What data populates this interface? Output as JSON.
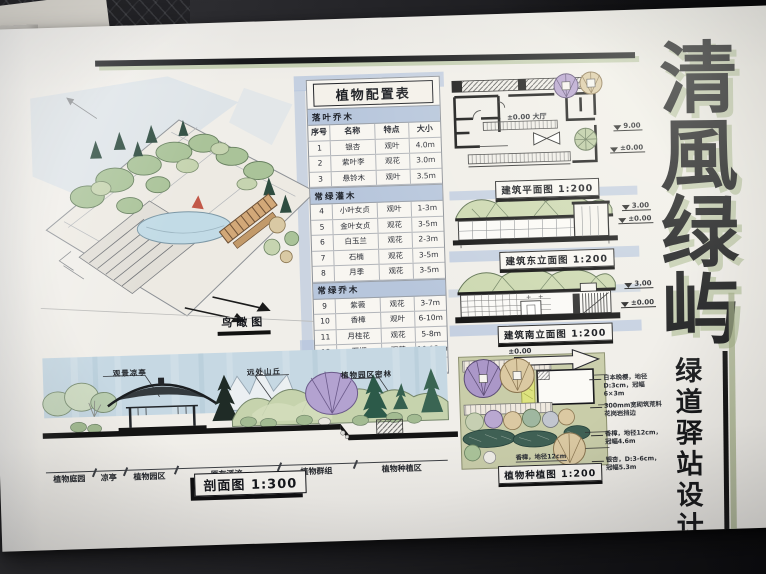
{
  "photo": {
    "paper_color": "#f0eee9",
    "desk_color": "#232327",
    "ink": "#1b1d20",
    "wash_blue": "#c6d8e3",
    "band_blue": "#b7c6dd",
    "marker_green": "#b9c7a2"
  },
  "title": {
    "main": "清風绿屿",
    "main_chars": [
      "清",
      "風",
      "绿",
      "屿"
    ],
    "sub": "绿道驿站设计",
    "sub_chars": [
      "绿",
      "道",
      "驿",
      "站",
      "设",
      "计"
    ]
  },
  "plant_table": {
    "title": "植物配置表",
    "columns": [
      "序号",
      "名称",
      "特点",
      "大小"
    ],
    "sections": [
      {
        "header": "落叶乔木",
        "rows": [
          [
            "1",
            "银杏",
            "观叶",
            "4.0m"
          ],
          [
            "2",
            "紫叶李",
            "观花",
            "3.0m"
          ],
          [
            "3",
            "悬铃木",
            "观叶",
            "3.5m"
          ]
        ]
      },
      {
        "header": "常绿灌木",
        "rows": [
          [
            "4",
            "小叶女贞",
            "观叶",
            "1-3m"
          ],
          [
            "5",
            "金叶女贞",
            "观花",
            "3-5m"
          ],
          [
            "6",
            "白玉兰",
            "观花",
            "2-3m"
          ],
          [
            "7",
            "石楠",
            "观花",
            "3-5m"
          ],
          [
            "8",
            "月季",
            "观花",
            "3-5m"
          ]
        ]
      },
      {
        "header": "常绿乔木",
        "rows": [
          [
            "9",
            "紫薇",
            "观花",
            "3-7m"
          ],
          [
            "10",
            "香樟",
            "观叶",
            "6-10m"
          ],
          [
            "11",
            "月桂花",
            "观花",
            "5-8m"
          ],
          [
            "12",
            "石榴",
            "观花",
            "10-12cm"
          ],
          [
            "13",
            "红枫",
            "观叶",
            "2-4m"
          ]
        ]
      }
    ]
  },
  "drawings": {
    "birdseye": {
      "label": "鸟瞰图"
    },
    "floor_plan": {
      "label": "建筑平面图 1:200",
      "interior_note": "±0.00 大厅",
      "marks": [
        "9.00",
        "±0.00"
      ]
    },
    "elevation_a": {
      "label": "建筑东立面图 1:200",
      "marks": [
        "3.00",
        "±0.00"
      ]
    },
    "elevation_b": {
      "label": "建筑南立面图 1:200",
      "marks": [
        "3.00",
        "±0.00"
      ]
    },
    "planting_plan": {
      "label": "植物种植图 1:200",
      "level_mark": "±0.00",
      "notes": [
        "日本晚樱，地径D:3cm，冠幅6×3m",
        "300mm宽砌筑荒料花岗岩挡边",
        "香樟，地径12cm，冠幅4.6m",
        "银杏，D:3-6cm，冠幅5.3m"
      ],
      "bottom_note": "香樟，地径12cm"
    },
    "section": {
      "label": "剖面图 1:300",
      "callouts": [
        "观景凉亭",
        "远处山丘",
        "植物园区密林"
      ],
      "zones": [
        "植物庭园",
        "凉亭",
        "植物园区",
        "原有溪流",
        "植物群组",
        "植物种植区"
      ]
    }
  }
}
